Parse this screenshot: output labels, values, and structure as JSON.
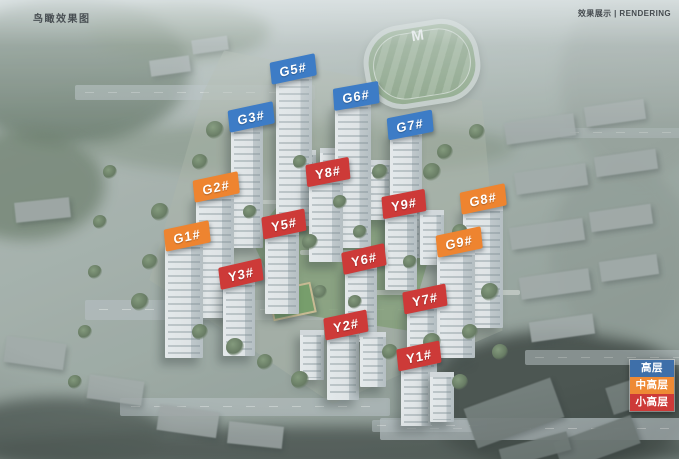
{
  "page": {
    "caption_top_left": "鸟瞰效果图",
    "caption_top_right": "效果展示 | RENDERING"
  },
  "sports_field_mark": "M",
  "colors": {
    "high-rise": "#3D7CC6",
    "mid-high-rise": "#EE8430",
    "small-high-rise": "#CD3A38"
  },
  "legend": {
    "items": [
      {
        "label": "高层",
        "type": "high-rise",
        "color": "#3E6FA9"
      },
      {
        "label": "中高层",
        "type": "mid-high-rise",
        "color": "#EE8A35"
      },
      {
        "label": "小高层",
        "type": "small-high-rise",
        "color": "#CD3A38"
      }
    ]
  },
  "buildings": [
    {
      "label": "G5#",
      "category": "high-rise",
      "x": 293,
      "y": 69,
      "rot": -12
    },
    {
      "label": "G6#",
      "category": "high-rise",
      "x": 356,
      "y": 96,
      "rot": -10
    },
    {
      "label": "G3#",
      "category": "high-rise",
      "x": 251,
      "y": 117,
      "rot": -12
    },
    {
      "label": "G7#",
      "category": "high-rise",
      "x": 410,
      "y": 125,
      "rot": -11
    },
    {
      "label": "G2#",
      "category": "mid-high-rise",
      "x": 216,
      "y": 187,
      "rot": -12
    },
    {
      "label": "G1#",
      "category": "mid-high-rise",
      "x": 187,
      "y": 236,
      "rot": -12
    },
    {
      "label": "G8#",
      "category": "mid-high-rise",
      "x": 483,
      "y": 199,
      "rot": -12
    },
    {
      "label": "G9#",
      "category": "mid-high-rise",
      "x": 459,
      "y": 242,
      "rot": -12
    },
    {
      "label": "Y8#",
      "category": "small-high-rise",
      "x": 328,
      "y": 172,
      "rot": -11
    },
    {
      "label": "Y5#",
      "category": "small-high-rise",
      "x": 284,
      "y": 224,
      "rot": -12
    },
    {
      "label": "Y9#",
      "category": "small-high-rise",
      "x": 404,
      "y": 204,
      "rot": -11
    },
    {
      "label": "Y3#",
      "category": "small-high-rise",
      "x": 241,
      "y": 274,
      "rot": -13
    },
    {
      "label": "Y6#",
      "category": "small-high-rise",
      "x": 364,
      "y": 259,
      "rot": -13
    },
    {
      "label": "Y7#",
      "category": "small-high-rise",
      "x": 425,
      "y": 299,
      "rot": -12
    },
    {
      "label": "Y2#",
      "category": "small-high-rise",
      "x": 346,
      "y": 325,
      "rot": -12
    },
    {
      "label": "Y1#",
      "category": "small-high-rise",
      "x": 419,
      "y": 356,
      "rot": -12
    }
  ]
}
